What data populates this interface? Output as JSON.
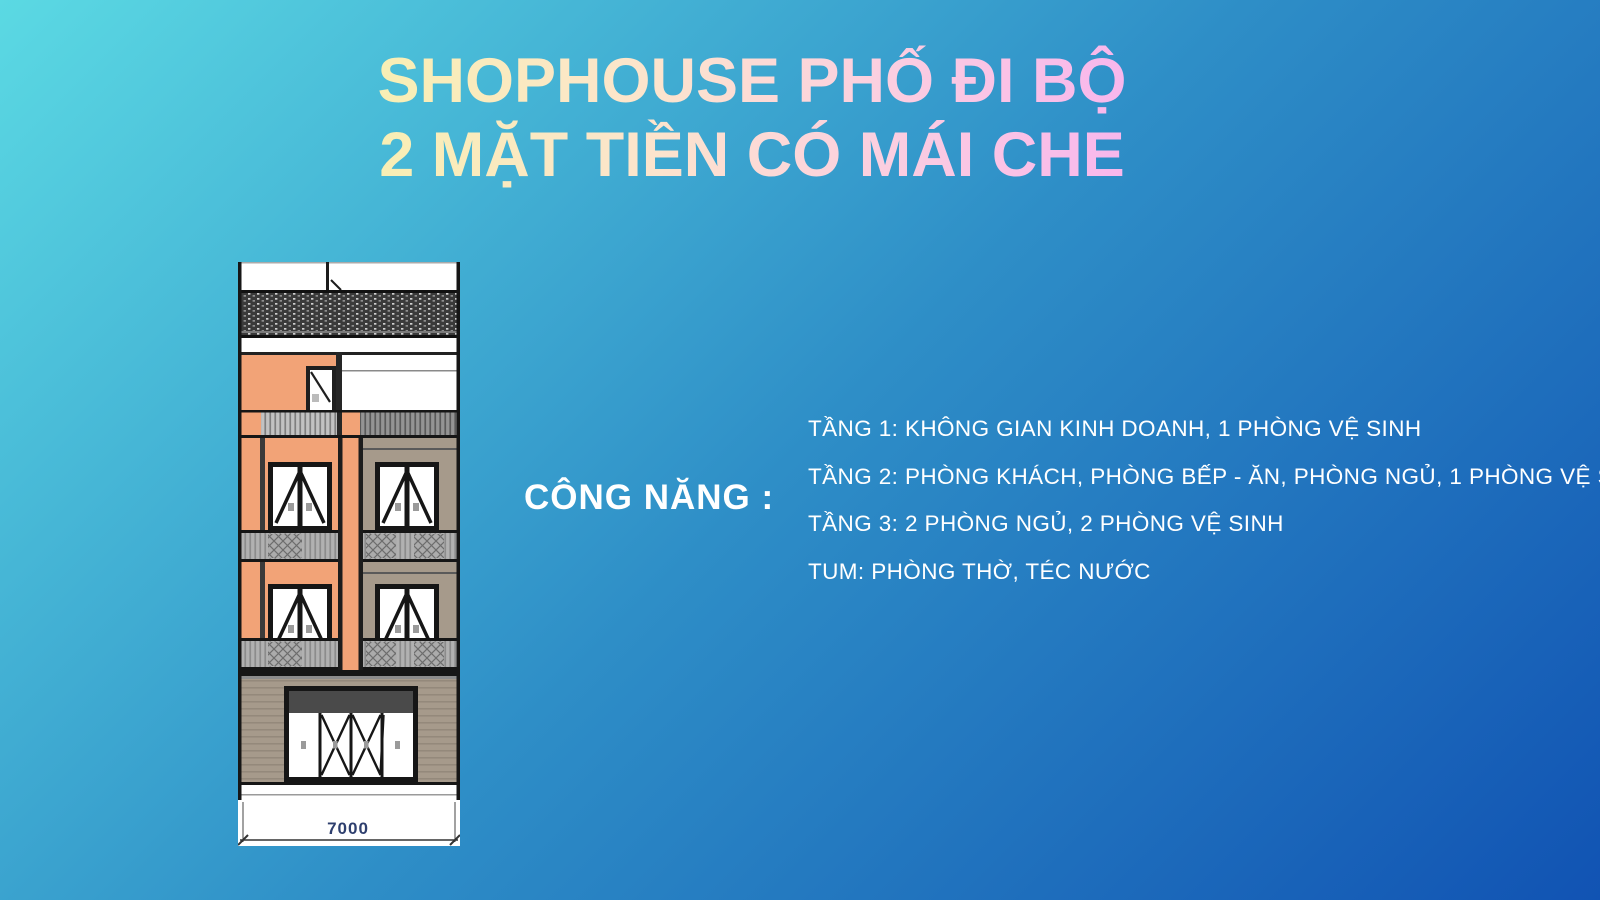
{
  "title": {
    "line1": "SHOPHOUSE PHỐ ĐI BỘ",
    "line2": "2 MẶT TIỀN CÓ MÁI CHE"
  },
  "functions": {
    "label": "CÔNG NĂNG :",
    "items": [
      "TẦNG 1: KHÔNG GIAN KINH DOANH, 1 PHÒNG VỆ SINH",
      "TẦNG 2: PHÒNG KHÁCH, PHÒNG BẾP - ĂN, PHÒNG NGỦ, 1 PHÒNG VỆ SINH",
      "TẦNG 3: 2 PHÒNG NGỦ, 2 PHÒNG VỆ SINH",
      "TUM: PHÒNG THỜ, TÉC NƯỚC"
    ]
  },
  "elevation": {
    "dimension_label": "7000"
  },
  "theme": {
    "bg_top_left": "#5bd9e3",
    "bg_middle": "#2e8ec7",
    "bg_bottom_right": "#1153b3",
    "title_g1": "#f8f0b2",
    "title_g2": "#fce4cd",
    "title_g3": "#fbcfe0",
    "title_g4": "#f8b4ee",
    "facade_orange": "#f2a377",
    "facade_taupe": "#a69a8b",
    "roof_dark": "#3a3a3a",
    "railing_gray": "#9c9c9c",
    "sign_band": "#4a4a4a",
    "dimension_text": "#2e3f6e",
    "text_white": "#ffffff"
  }
}
